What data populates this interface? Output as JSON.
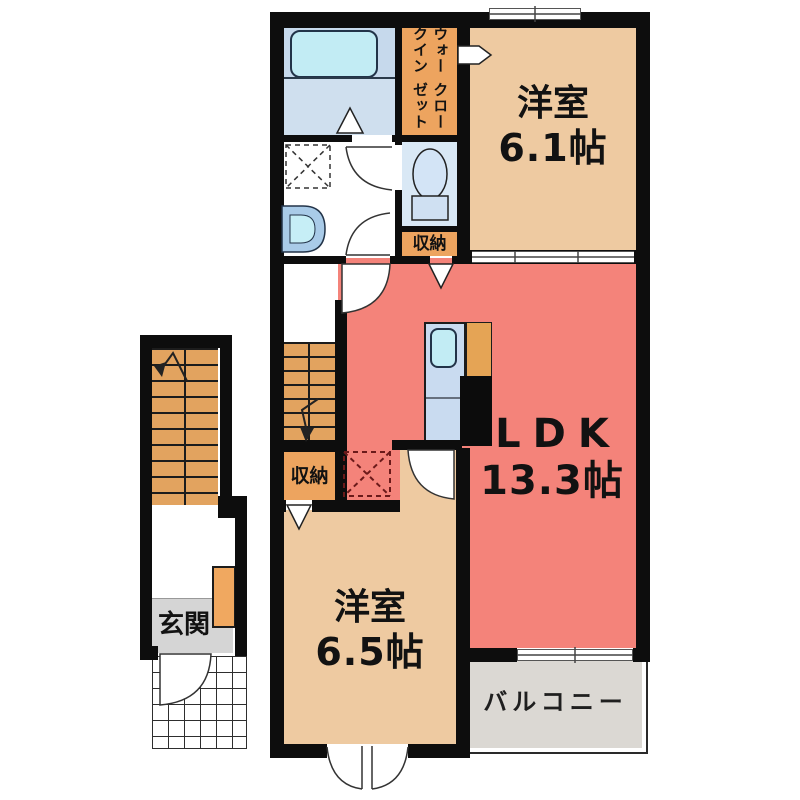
{
  "rooms": {
    "bedroom_top": {
      "name": "洋室",
      "size": "6.1帖"
    },
    "ldk": {
      "name": "LDK",
      "size": "13.3帖"
    },
    "bedroom_bottom": {
      "name": "洋室",
      "size": "6.5帖"
    },
    "balcony": {
      "name": "バルコニー"
    },
    "entrance": {
      "name": "玄関"
    },
    "walk_in_closet": {
      "line1": "ウォークイン",
      "line2": "クローゼット"
    },
    "storage_upper": {
      "name": "収納"
    },
    "storage_lower": {
      "name": "収納"
    }
  },
  "colors": {
    "wall_black": "#0d0d0d",
    "room_beige": "#eecaa1",
    "ldk_salmon": "#f4837a",
    "closet_orange": "#eda45f",
    "stairs_orange": "#e2a35f",
    "bath_blue": "#cfdfee",
    "bath_upper_blue": "#c6d9ec",
    "toilet_blue": "#d9e8f5",
    "tub_cyan": "#c2ecf4",
    "counter_blue": "#c9dbf0",
    "kitchen_orange": "#e5a455",
    "balcony_gray": "#dbd8d3",
    "entrance_gray": "#d5d5d5"
  }
}
